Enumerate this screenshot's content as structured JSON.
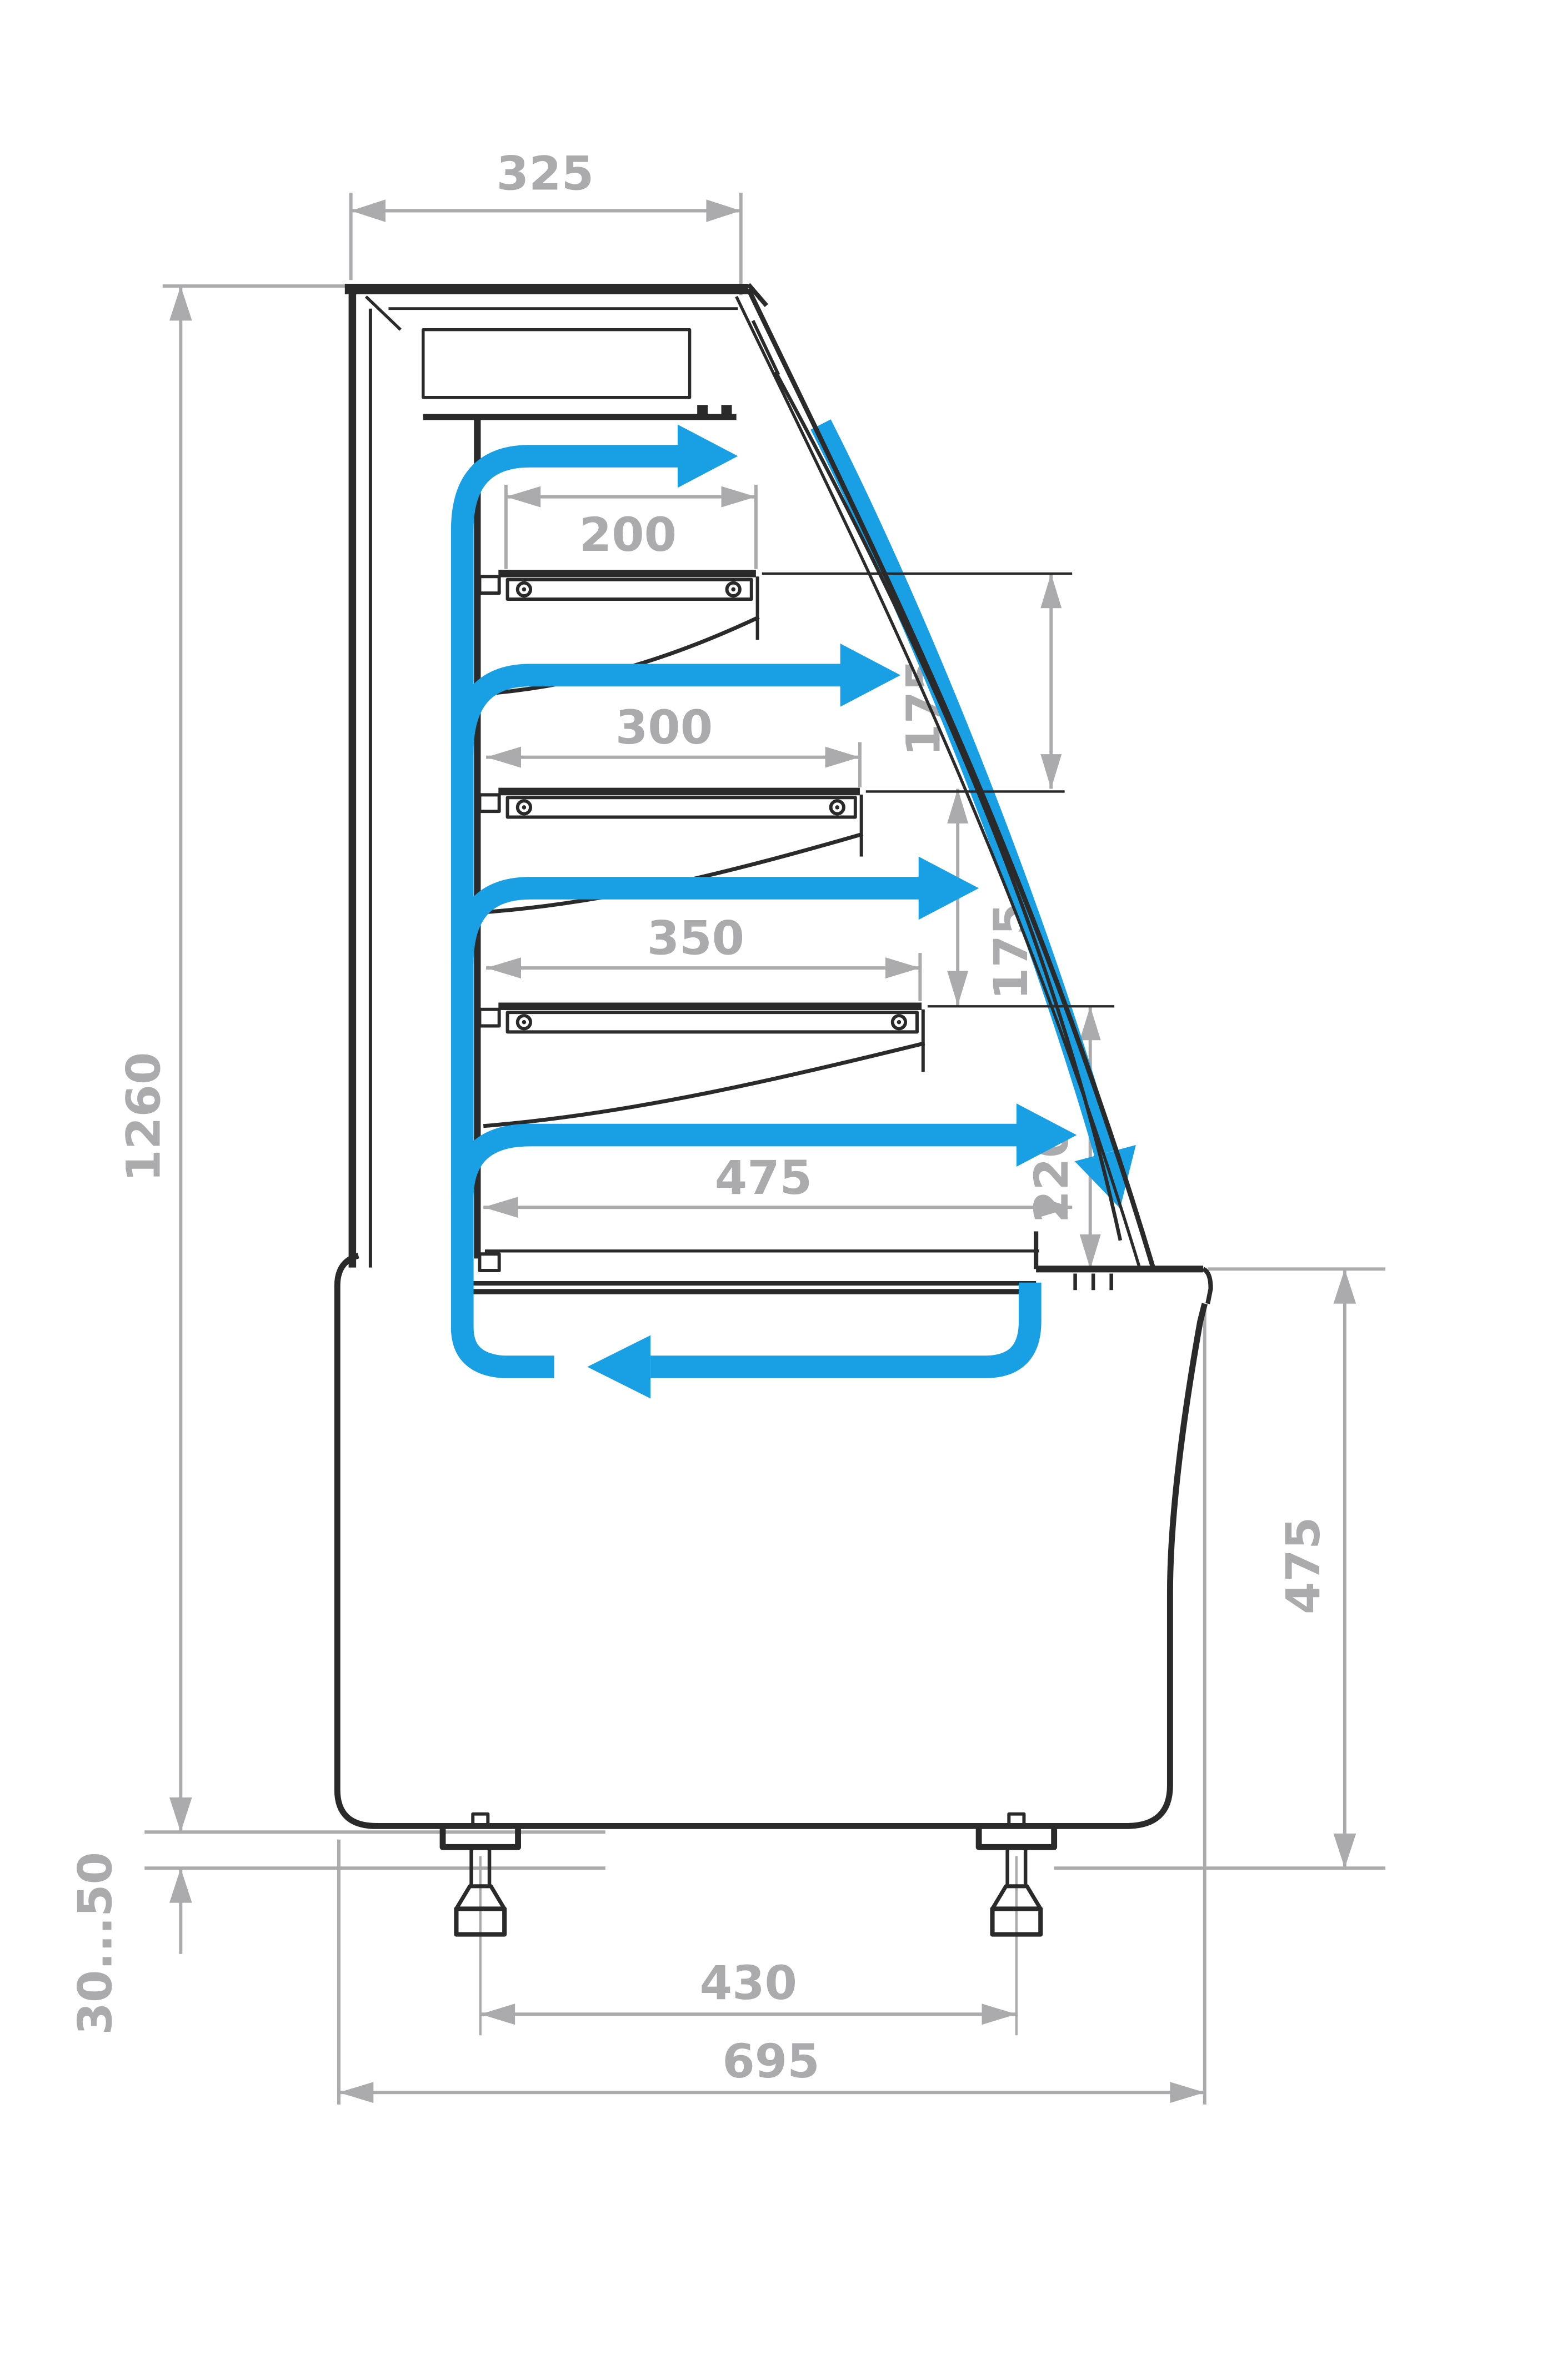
{
  "diagram": {
    "title": "refrigerated display case side section with airflow",
    "dimensions": {
      "top_depth": "325",
      "overall_height": "1260",
      "shelf1_depth": "200",
      "shelf2_depth": "300",
      "shelf3_depth": "350",
      "well_depth": "475",
      "shelf_gap_1": "175",
      "shelf_gap_2": "175",
      "front_gap": "220",
      "base_height": "475",
      "leg_spacing": "430",
      "overall_depth": "695",
      "leg_adjustment": "30...50"
    },
    "colors": {
      "airflow": "#189FE4",
      "dimension": "#ABABAE",
      "outline": "#2A2A2A"
    }
  }
}
